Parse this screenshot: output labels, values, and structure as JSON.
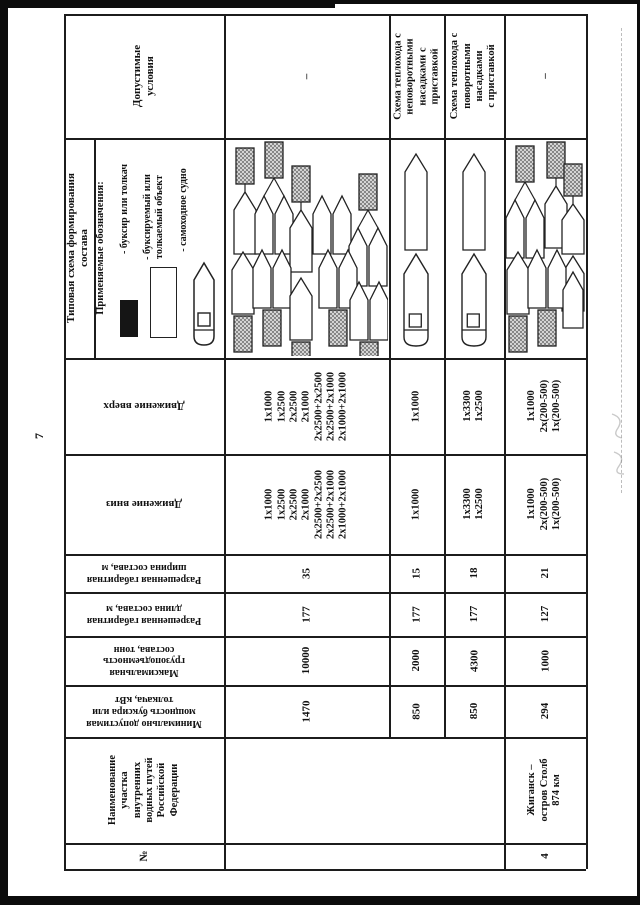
{
  "page_number": "7",
  "headers": {
    "allowed_conditions": "Допустимые\nусловия",
    "scheme_title": "Типовая схема формирования\nсостава",
    "legend_title": "Применяемые обозначения:",
    "movement_up": "Движение вверх",
    "movement_down": "Движение вниз",
    "allowed_width": "Разрешенная габаритная\nширина состава, м",
    "allowed_length": "Разрешенная габаритная\nдлина состава, м",
    "max_capacity": "Максимальная\nгрузоподъемность\nсостава, тонн",
    "min_power": "Минимально допустимая\nмощность буксира или\nтолкача, кВт",
    "section_name": "Наименование\nучастка\nвнутренних\nводных путей\nРоссийской\nФедерации",
    "number": "№"
  },
  "legend": {
    "items": [
      {
        "symbol": "tug-symbol",
        "label": "- буксир или толкач"
      },
      {
        "symbol": "towed-object-symbol",
        "label": "- буксируемый или\nтолкаемый объект"
      },
      {
        "symbol": "self-propelled-symbol",
        "label": "- самоходное судно"
      }
    ]
  },
  "conditions": {
    "r1": "–",
    "r2": "Схема теплохода с\nнеповоротными\nнасадками с\nприставкой",
    "r3": "Схема теплохода с\nповоротными\nнасадками\nс приставкой",
    "r4": "–"
  },
  "movement_up": {
    "r1": "1x1000\n1x2500\n2x2500\n2x1000\n2x2500+2x2500\n2x2500+2x1000\n2x1000+2x1000",
    "r2": "1x1000",
    "r3": "1x3300\n1x2500",
    "r4": "1x1000\n2x(200-500)\n1x(200-500)"
  },
  "movement_down": {
    "r1": "1x1000\n1x2500\n2x2500\n2x1000\n2x2500+2x2500\n2x2500+2x1000\n2x1000+2x1000",
    "r2": "1x1000",
    "r3": "1x3300\n1x2500",
    "r4": "1x1000\n2x(200-500)\n1x(200-500)"
  },
  "allowed_width": {
    "r1": "35",
    "r2": "15",
    "r3": "18",
    "r4": "21"
  },
  "allowed_length": {
    "r1": "177",
    "r2": "177",
    "r3": "177",
    "r4": "127"
  },
  "max_capacity": {
    "r1": "10000",
    "r2": "2000",
    "r3": "4300",
    "r4": "1000"
  },
  "min_power": {
    "r1": "1470",
    "r2": "850",
    "r3": "850",
    "r4": "294"
  },
  "sections": {
    "r4_name": "Жиганск –\nостров Столб\n874 км",
    "r4_no": "4"
  },
  "schemes": {
    "row1": [
      {
        "kind": "tow1",
        "x": 8,
        "y": 8
      },
      {
        "kind": "tow2",
        "x": 30,
        "y": 2
      },
      {
        "kind": "tow1",
        "x": 64,
        "y": 26
      },
      {
        "kind": "pair",
        "x": 88,
        "y": 56
      },
      {
        "kind": "tow2",
        "x": 124,
        "y": 34
      },
      {
        "kind": "push1",
        "x": 6,
        "y": 112
      },
      {
        "kind": "push2",
        "x": 28,
        "y": 110
      },
      {
        "kind": "push1",
        "x": 64,
        "y": 138
      },
      {
        "kind": "push2",
        "x": 94,
        "y": 110
      },
      {
        "kind": "push2",
        "x": 125,
        "y": 142
      }
    ],
    "row2": [
      {
        "kind": "motor",
        "x": 13,
        "y": 14
      }
    ],
    "row3": [
      {
        "kind": "motor",
        "x": 16,
        "y": 14
      }
    ],
    "row4": [
      {
        "kind": "tow2",
        "x": 1,
        "y": 6
      },
      {
        "kind": "tow1",
        "x": 39,
        "y": 2
      },
      {
        "kind": "towt",
        "x": 56,
        "y": 24
      },
      {
        "kind": "push1",
        "x": 1,
        "y": 112
      },
      {
        "kind": "push2",
        "x": 23,
        "y": 110
      },
      {
        "kind": "single",
        "x": 58,
        "y": 132
      }
    ]
  }
}
